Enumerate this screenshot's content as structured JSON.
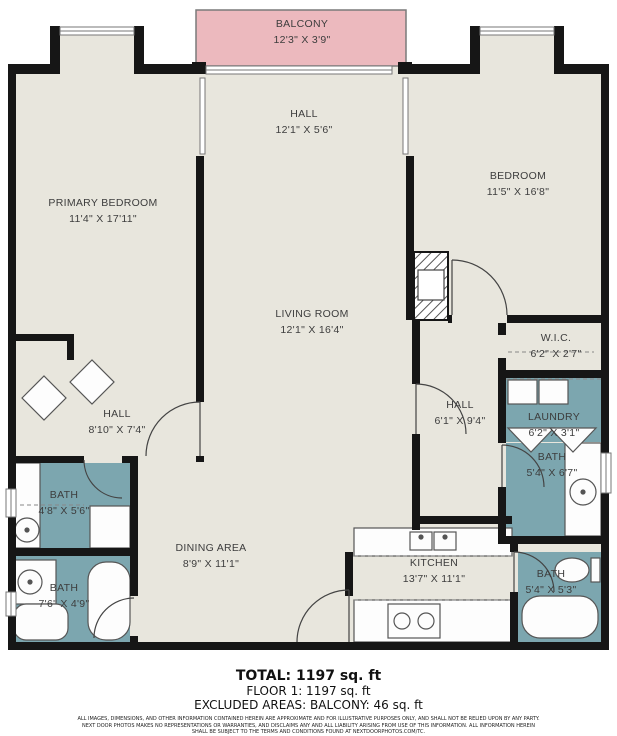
{
  "title": "Floor plan",
  "colors": {
    "floor": "#e8e6dd",
    "wall": "#161616",
    "balcony_fill": "#ecb9be",
    "wet_room_fill": "#7ca6af",
    "label_text": "#3d3d3d"
  },
  "rooms": [
    {
      "id": "balcony",
      "name": "BALCONY",
      "dims": "12'3\" X 3'9\""
    },
    {
      "id": "hall-top",
      "name": "HALL",
      "dims": "12'1\" X 5'6\""
    },
    {
      "id": "primary-bedroom",
      "name": "PRIMARY BEDROOM",
      "dims": "11'4\" X 17'11\""
    },
    {
      "id": "bedroom",
      "name": "BEDROOM",
      "dims": "11'5\" X 16'8\""
    },
    {
      "id": "living-room",
      "name": "LIVING ROOM",
      "dims": "12'1\" X 16'4\""
    },
    {
      "id": "wic",
      "name": "W.I.C.",
      "dims": "6'2\" X 2'7\""
    },
    {
      "id": "hall-left",
      "name": "HALL",
      "dims": "8'10\" X 7'4\""
    },
    {
      "id": "hall-right",
      "name": "HALL",
      "dims": "6'1\" X 9'4\""
    },
    {
      "id": "laundry",
      "name": "LAUNDRY",
      "dims": "6'2\" X 3'1\""
    },
    {
      "id": "bath-right",
      "name": "BATH",
      "dims": "5'4\" X 6'7\""
    },
    {
      "id": "bath-left-top",
      "name": "BATH",
      "dims": "4'8\" X 5'6\""
    },
    {
      "id": "bath-left-bottom",
      "name": "BATH",
      "dims": "7'6\" X 4'9\""
    },
    {
      "id": "dining-area",
      "name": "DINING AREA",
      "dims": "8'9\" X 11'1\""
    },
    {
      "id": "kitchen",
      "name": "KITCHEN",
      "dims": "13'7\" X 11'1\""
    },
    {
      "id": "bath-bottom-right",
      "name": "BATH",
      "dims": "5'4\" X 5'3\""
    }
  ],
  "summary": {
    "total": "TOTAL: 1197 sq. ft",
    "floor1": "FLOOR 1: 1197 sq. ft",
    "excluded": "EXCLUDED AREAS: BALCONY: 46 sq. ft"
  },
  "disclaimer": {
    "line1": "ALL IMAGES, DIMENSIONS, AND OTHER INFORMATION CONTAINED HEREIN ARE APPROXIMATE AND FOR ILLUSTRATIVE PURPOSES ONLY, AND SHALL NOT BE RELIED UPON BY ANY PARTY.",
    "line2": "NEXT DOOR PHOTOS MAKES NO REPRESENTATIONS OR WARRANTIES, AND DISCLAIMS ANY AND ALL LIABILITY ARISING FROM USE OF THIS INFORMATION. ALL INFORMATION HEREIN",
    "line3": "SHALL BE SUBJECT TO THE TERMS AND CONDITIONS FOUND AT NEXTDOORPHOTOS.COM/TC."
  }
}
